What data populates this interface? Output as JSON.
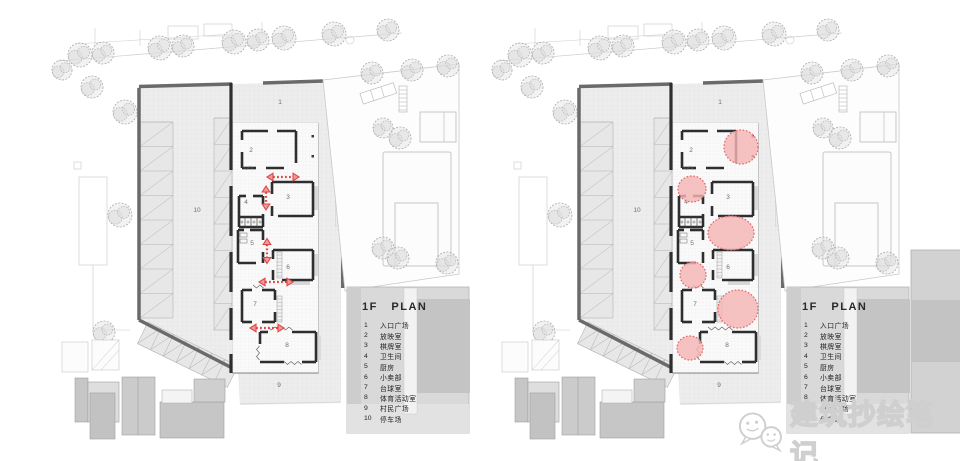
{
  "page": {
    "background": "#ffffff"
  },
  "plans": [
    {
      "id": "plan-left",
      "name": "1F plan - circulation arrows",
      "variant": "arrows"
    },
    {
      "id": "plan-right",
      "name": "1F plan - activity bubbles",
      "variant": "bubbles"
    }
  ],
  "legend": {
    "title": "1F PLAN",
    "items": [
      {
        "num": "1",
        "label": "入口广场"
      },
      {
        "num": "2",
        "label": "放映室"
      },
      {
        "num": "3",
        "label": "棋牌室"
      },
      {
        "num": "4",
        "label": "卫生间"
      },
      {
        "num": "5",
        "label": "厨房"
      },
      {
        "num": "6",
        "label": "小卖部"
      },
      {
        "num": "7",
        "label": "台球室"
      },
      {
        "num": "8",
        "label": "体育活动室"
      },
      {
        "num": "9",
        "label": "村民广场"
      },
      {
        "num": "10",
        "label": "停车场"
      }
    ]
  },
  "room_labels": [
    {
      "num": "1",
      "x": 280,
      "y": 104
    },
    {
      "num": "2",
      "x": 251,
      "y": 152
    },
    {
      "num": "3",
      "x": 288,
      "y": 199
    },
    {
      "num": "4",
      "x": 246,
      "y": 204
    },
    {
      "num": "5",
      "x": 252,
      "y": 245
    },
    {
      "num": "6",
      "x": 288,
      "y": 269
    },
    {
      "num": "7",
      "x": 255,
      "y": 306
    },
    {
      "num": "8",
      "x": 287,
      "y": 347
    },
    {
      "num": "9",
      "x": 279,
      "y": 387
    },
    {
      "num": "10",
      "x": 197,
      "y": 212
    }
  ],
  "annotations": {
    "arrows": [
      {
        "dir": "h",
        "x": 283,
        "y": 177,
        "len": 32
      },
      {
        "dir": "v",
        "x": 266,
        "y": 198,
        "len": 24
      },
      {
        "dir": "v",
        "x": 267,
        "y": 251,
        "len": 25
      },
      {
        "dir": "h",
        "x": 276,
        "y": 282,
        "len": 34
      },
      {
        "dir": "h",
        "x": 267,
        "y": 328,
        "len": 34
      }
    ],
    "bubbles": [
      {
        "x": 301,
        "y": 147,
        "rx": 17,
        "ry": 17
      },
      {
        "x": 252,
        "y": 189,
        "rx": 14,
        "ry": 13
      },
      {
        "x": 291,
        "y": 233,
        "rx": 23,
        "ry": 17
      },
      {
        "x": 253,
        "y": 275,
        "rx": 13,
        "ry": 13
      },
      {
        "x": 298,
        "y": 309,
        "rx": 20,
        "ry": 19
      },
      {
        "x": 250,
        "y": 348,
        "rx": 13,
        "ry": 12
      }
    ]
  },
  "watermark": {
    "text": "建筑抄绘笔记",
    "icon": "wechat-icon"
  },
  "colors": {
    "arrow": "#e04545",
    "arrow_head_fill": "#ef9a9a",
    "bubble_fill": "#f5b5b5",
    "bubble_stroke": "#e26868",
    "wall_dark": "#6a6a6a",
    "wall_black": "#2e2e2e",
    "plaza": "#ededed",
    "label": "#6e6e6e",
    "watermark_gray": "#cfcfcf"
  }
}
